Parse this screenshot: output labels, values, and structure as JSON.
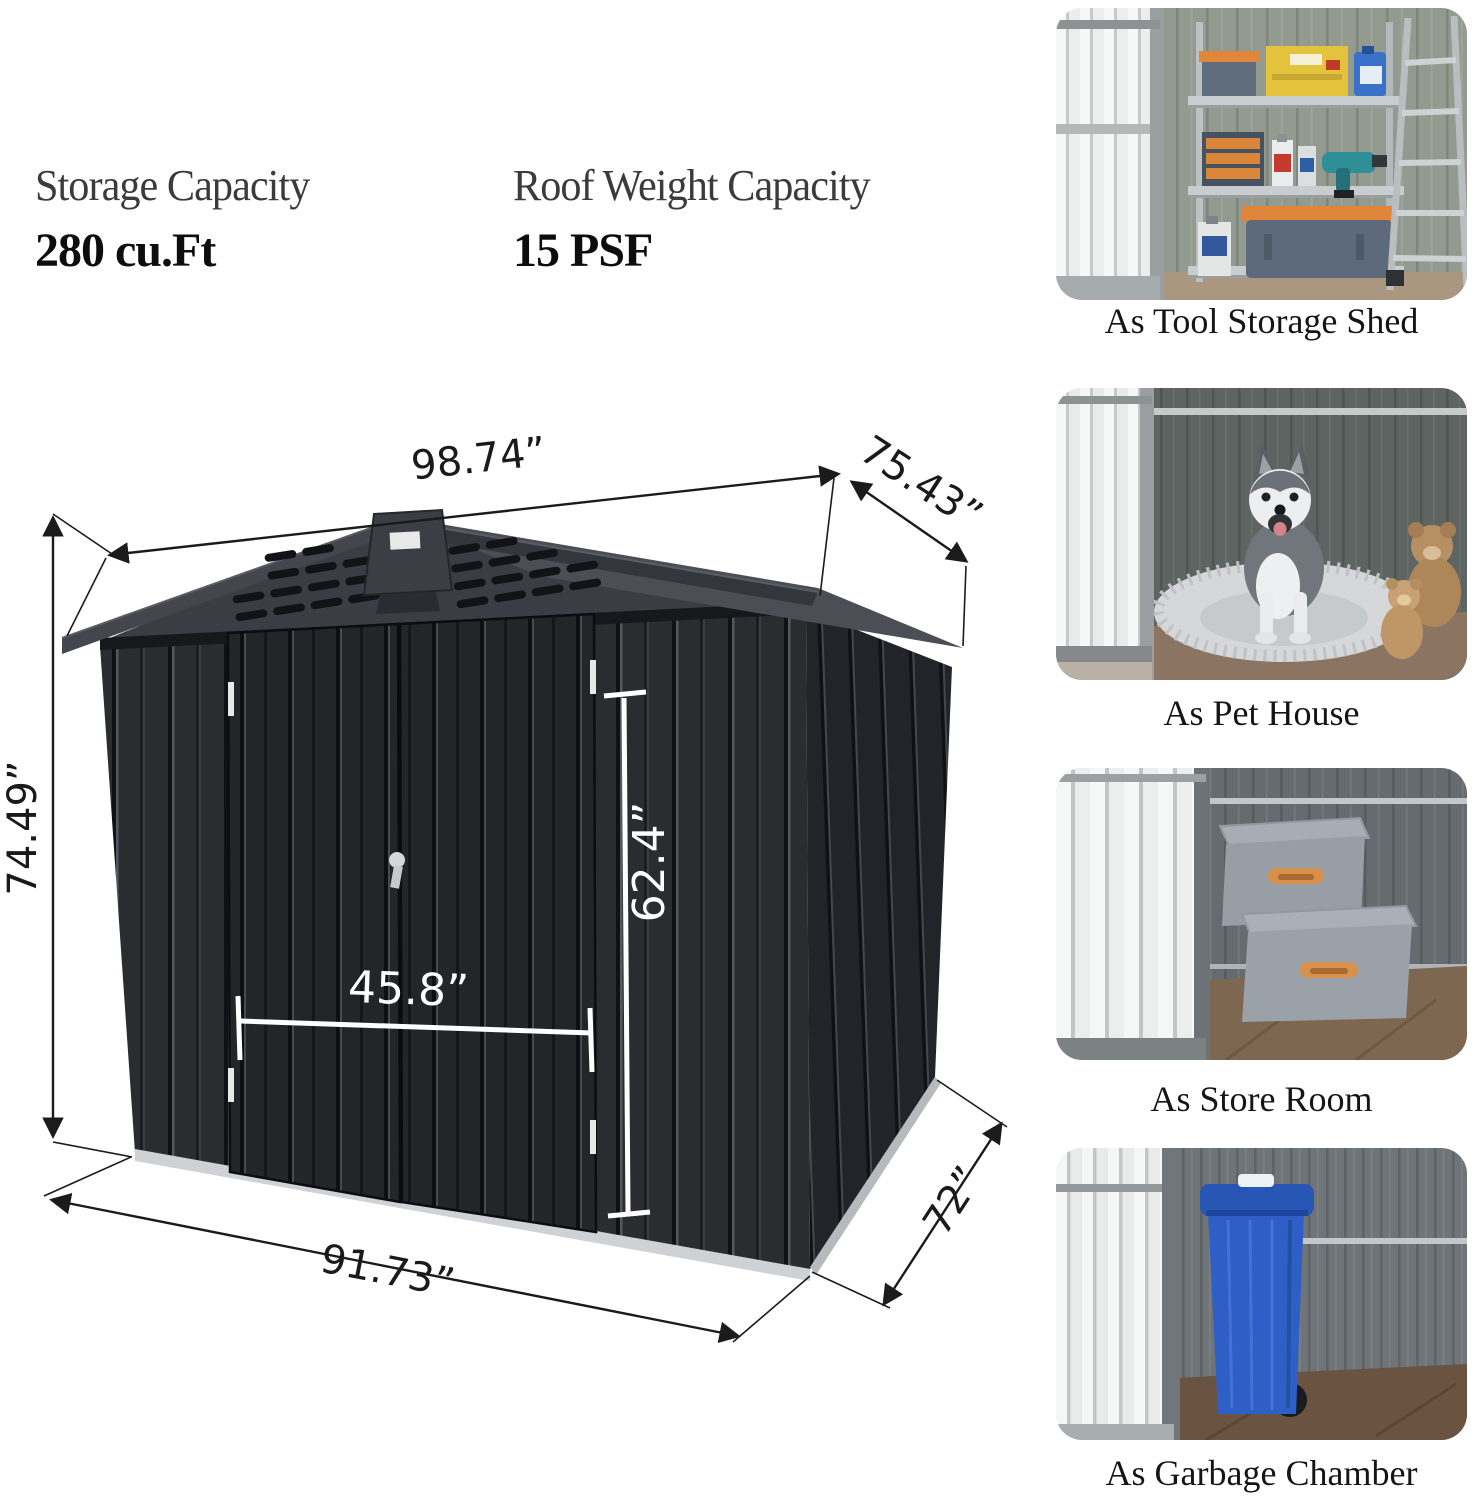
{
  "specs": [
    {
      "label": "Storage Capacity",
      "value": "280 cu.Ft"
    },
    {
      "label": "Roof Weight Capacity",
      "value": "15 PSF"
    }
  ],
  "diagram": {
    "dimensions": {
      "top_width": "98.74”",
      "top_depth": "75.43”",
      "side_height": "74.49”",
      "door_width": "45.8”",
      "door_height": "62.4”",
      "base_width": "91.73”",
      "base_depth": "72”"
    },
    "colors": {
      "shed_body": "#26282c",
      "shed_roof": "#4b4e54",
      "base_trim": "#cfd2d4",
      "dim_line_dark": "#1b1b1b",
      "dim_line_light": "#ffffff"
    }
  },
  "use_cases": [
    {
      "caption": "As Tool Storage Shed",
      "accent": "#d8914d"
    },
    {
      "caption": "As Pet House",
      "accent": "#5d6461"
    },
    {
      "caption": "As Store Room",
      "accent": "#d8914d"
    },
    {
      "caption": "As Garbage Chamber",
      "accent": "#2d5fc7"
    }
  ]
}
